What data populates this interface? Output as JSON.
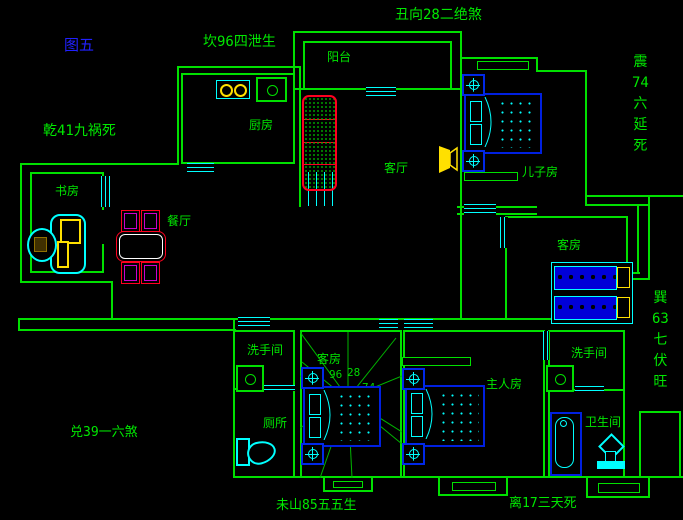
{
  "figure": {
    "label": "图五"
  },
  "annotations": {
    "kan": "坎96四泄生",
    "chou": "丑向28二绝煞",
    "qian": "乾41九祸死",
    "dui": "兑39一六煞",
    "wei": "未山85五五生",
    "li": "离17三天死",
    "zhen": [
      "震",
      "74",
      "六",
      "延",
      "死"
    ],
    "xun": [
      "巽",
      "63",
      "七",
      "伏",
      "旺"
    ]
  },
  "rooms": {
    "balcony": "阳台",
    "kitchen": "厨房",
    "study": "书房",
    "dining": "餐厅",
    "living": "客厅",
    "son": "儿子房",
    "guest_right": "客房",
    "guest_center": "客房",
    "wash_left": "洗手间",
    "toilet": "厕所",
    "master": "主人房",
    "wash_right": "洗手间",
    "bath": "卫生间"
  },
  "compass_numbers": [
    "96",
    "28",
    "41",
    "74",
    "39",
    "63",
    "85",
    "17"
  ],
  "colors": {
    "background": "#000000",
    "wall_green": "#00e000",
    "text_green": "#00e800",
    "figure_blue": "#2020ff",
    "window_cyan": "#00ffff",
    "furniture_blue": "#0020e0",
    "accent_yellow": "#ffe000",
    "accent_red": "#ff0020",
    "accent_magenta": "#cc00cc"
  }
}
